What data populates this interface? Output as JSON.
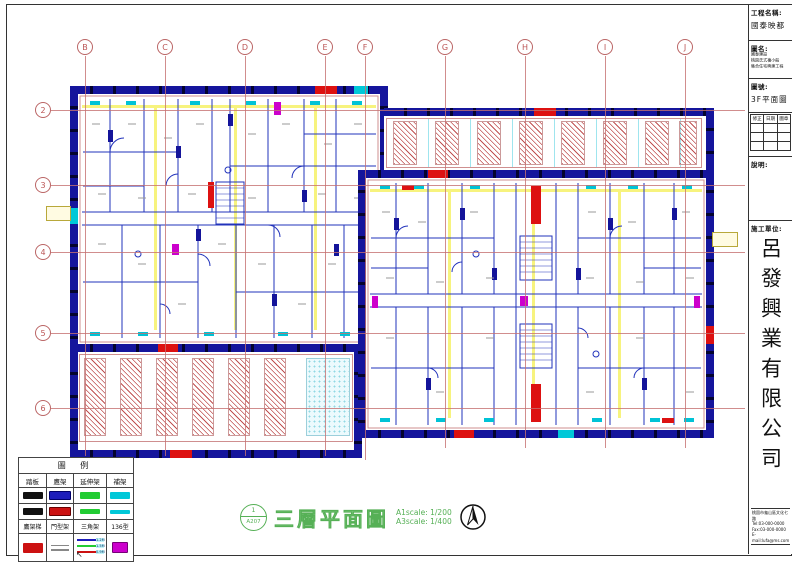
{
  "title_block": {
    "project_label": "工程名稱:",
    "project_name": "國泰映都",
    "name_label": "圖名:",
    "name_lines": [
      "國泰建設",
      "桃園氏式複小般",
      "集合住宅興建工程"
    ],
    "number_label": "圖號:",
    "number_value": "3F平面圖",
    "rev_headers": [
      "修正",
      "日期",
      "圖章"
    ],
    "notes_label": "說明:",
    "contractor_label": "施工單位:",
    "contractor_name": "呂發興業有限公司",
    "contact_lines": [
      "桃園市龜山區文化七路",
      "Tel:03-000-0000",
      "Fax:03-000-0000",
      "E-mail:lufa@ms.com"
    ],
    "owner_label": "業主:"
  },
  "grid": {
    "top": [
      "B",
      "C",
      "D",
      "E",
      "F",
      "G",
      "H",
      "I",
      "J"
    ],
    "left": [
      "2",
      "3",
      "4",
      "5",
      "6"
    ]
  },
  "legend": {
    "title": "圖 例",
    "row1": [
      "踏板",
      "鷹架",
      "延伸架",
      "補架"
    ],
    "row2": [
      "鷹架梯",
      "門型架",
      "三角架",
      "136型"
    ],
    "triangle_labels": [
      "1.2M",
      "1.5M",
      "0.9M"
    ]
  },
  "footer": {
    "stamp_top": "1",
    "stamp_bottom": "A207",
    "title": "三層平面圖",
    "scale_a1": "A1scale: 1/200",
    "scale_a3": "A3scale: 1/400"
  },
  "colors": {
    "scaffold_navy": "#15159c",
    "scaffold_red": "#dd1111",
    "extension_green": "#22cc33",
    "repair_cyan": "#00c8d8",
    "type136_magenta": "#cc00cc",
    "hatch_red": "#c05050",
    "axis_pink": "#c57070",
    "footer_green": "#56b056"
  }
}
